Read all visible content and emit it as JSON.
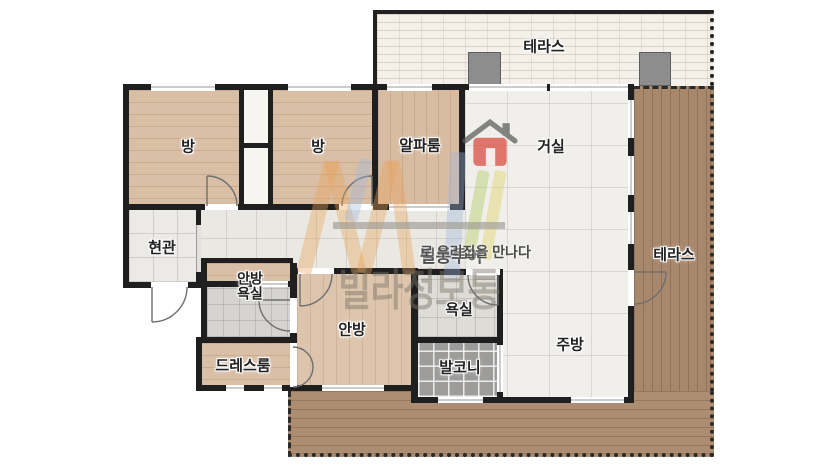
{
  "floorplan": {
    "labels": {
      "terrace_top": "테라스",
      "terrace_right": "테라스",
      "room1": "방",
      "room2": "방",
      "alpha_room": "알파룸",
      "living_room": "거실",
      "entrance": "현관",
      "master_bath": "안방\n욕실",
      "dress_room": "드레스룸",
      "master_bedroom": "안방",
      "bathroom": "욕실",
      "balcony": "발코니",
      "kitchen": "주방"
    },
    "watermark": {
      "tagline_bold": "빌통투어",
      "tagline_rest": "로 우리집을 만나다",
      "brand": "빌라정보통"
    },
    "colors": {
      "wall": "#1f1f1f",
      "room_wood": "#dabfa7",
      "terrace_wood": "#a8886d",
      "light_tile": "#f0efeb",
      "balcony_tile": "#9d9c9a",
      "terrace_brick": "#f4f1ea",
      "pillar_gray": "#8d8d8d",
      "logo_orange": "#e8a45a",
      "logo_blue": "#9db9dc",
      "logo_green": "#a7c54e",
      "logo_yellow": "#d9cf52",
      "logo_red": "#d9473c"
    }
  }
}
